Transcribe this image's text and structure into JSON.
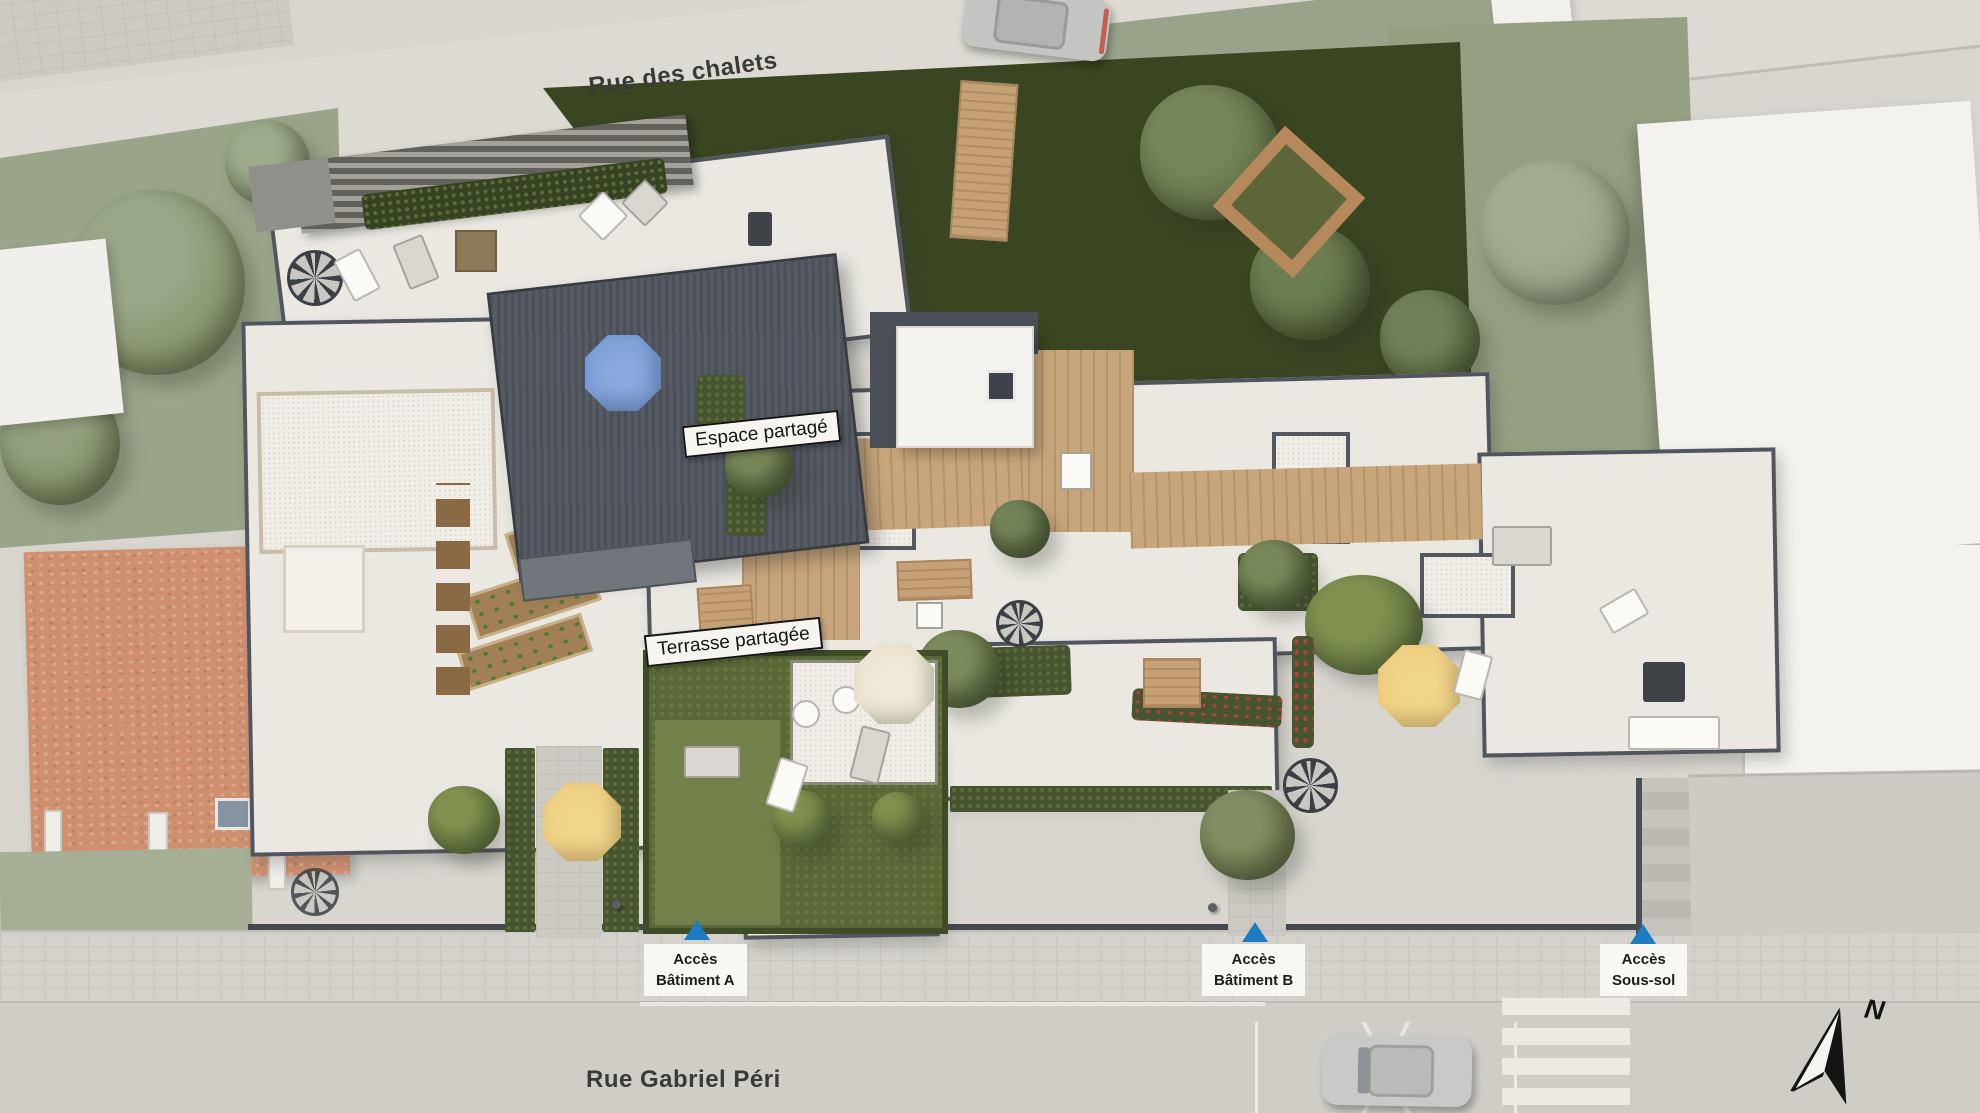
{
  "site_plan": {
    "streets": {
      "top": "Rue des chalets",
      "bottom": "Rue Gabriel Péri"
    },
    "area_labels": {
      "shared_space": "Espace partagé",
      "shared_terrace": "Terrasse partagée"
    },
    "access_points": [
      {
        "line1": "Accès",
        "line2": "Bâtiment A"
      },
      {
        "line1": "Accès",
        "line2": "Bâtiment B"
      },
      {
        "line1": "Accès",
        "line2": "Sous-sol"
      }
    ],
    "compass": {
      "north": "N"
    },
    "colors": {
      "access_arrow_blue": "#1e7dc2",
      "terrace_cream": "#eae8e1",
      "parapet_gray": "#51555d",
      "deck_wood": "#c8a67c",
      "shared_roof_gray": "#50555e",
      "pond_green": "#3a4522",
      "hedge_green": "#465530",
      "lawn_green": "#72814a",
      "terracotta_roof": "#d0906f",
      "road_gray": "#d6d4cd",
      "parasol_blue": "#7097d3",
      "parasol_yellow": "#eccb7c",
      "parasol_cream": "#e9e1cd"
    }
  }
}
